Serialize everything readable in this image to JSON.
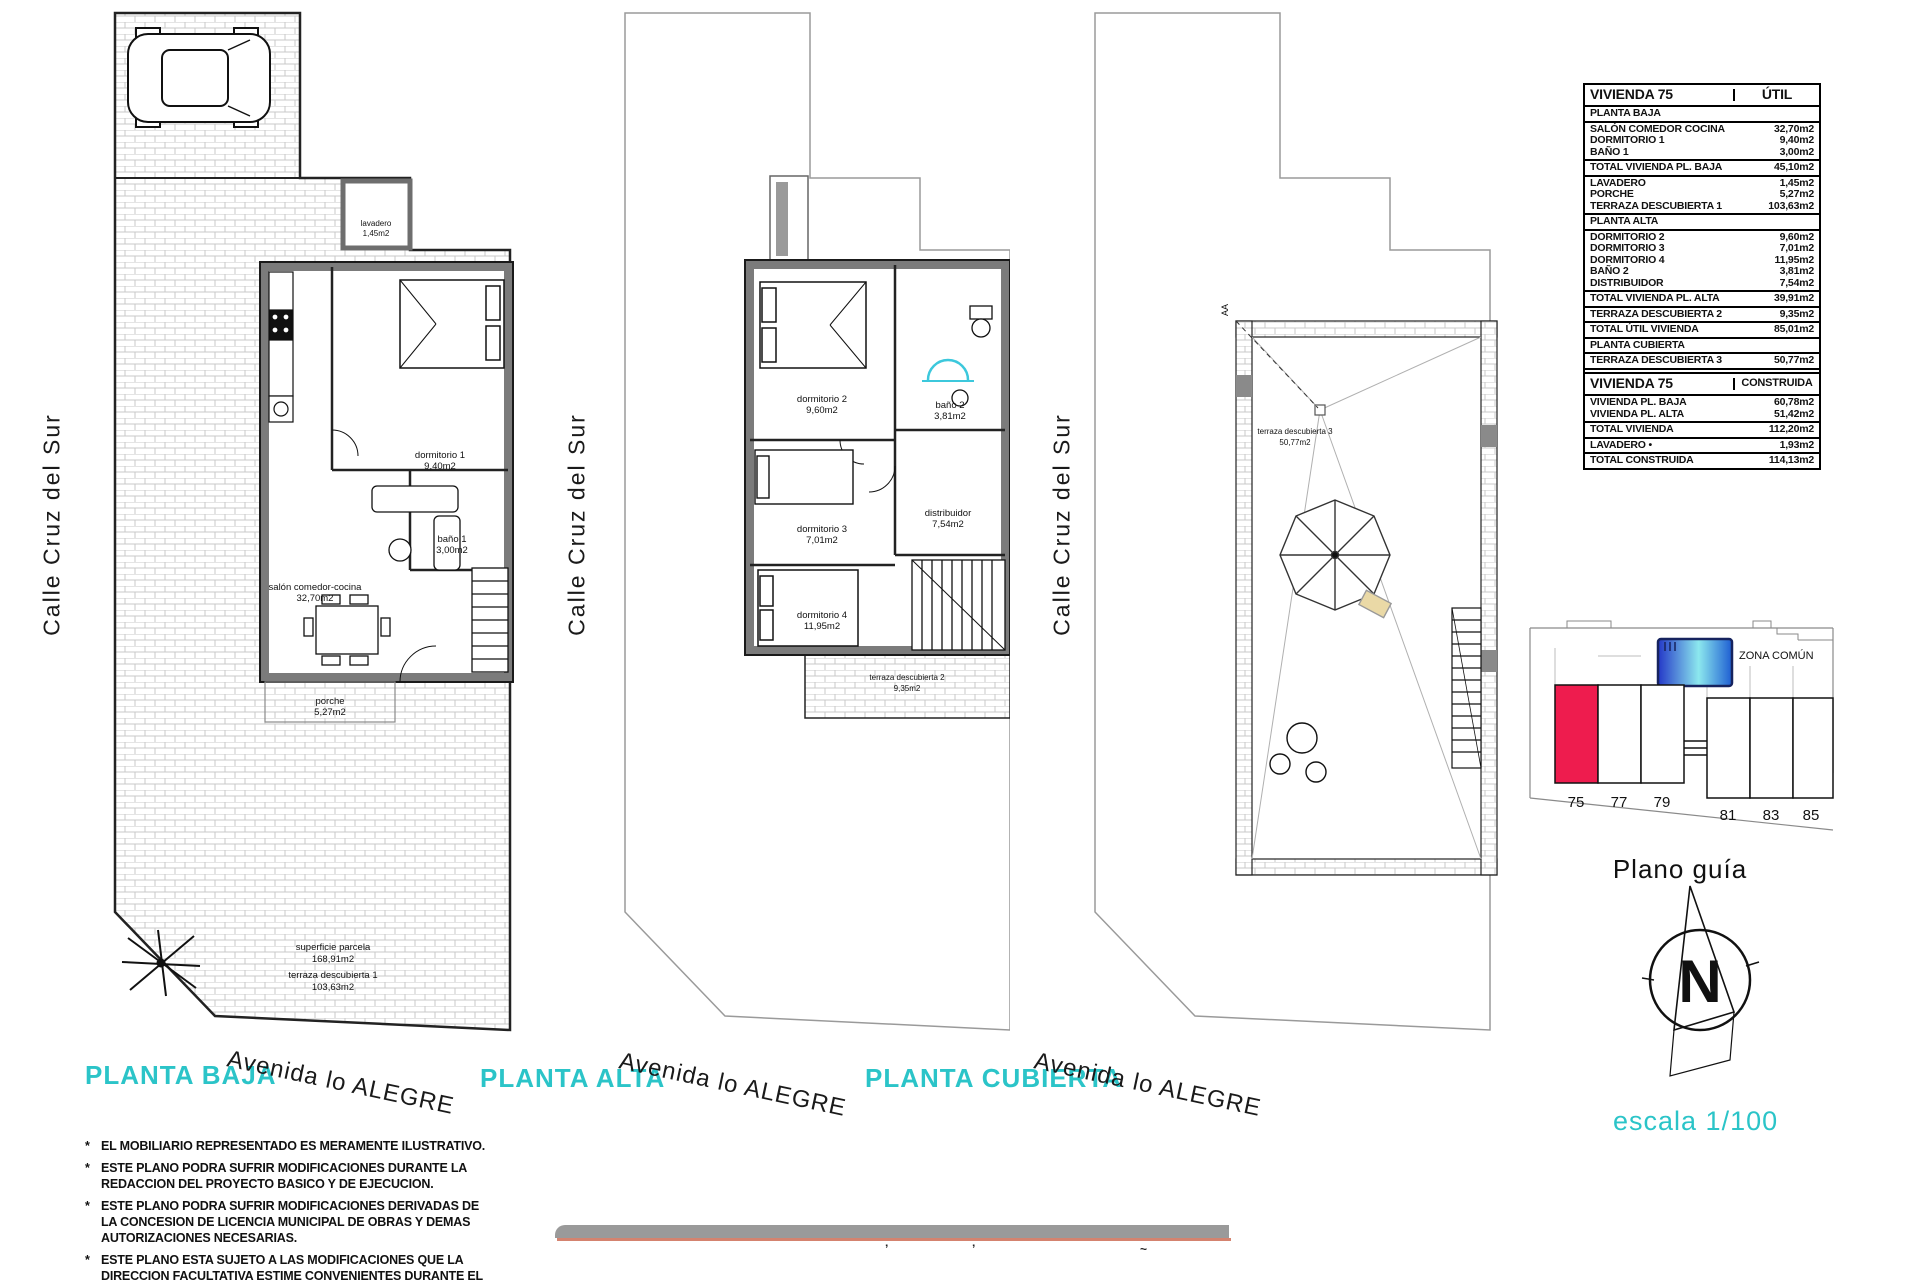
{
  "plans": [
    {
      "title": "PLANTA BAJA",
      "street": "Calle Cruz del Sur",
      "avenue": "Avenida lo ALEGRE",
      "rooms": [
        {
          "name": "lavadero",
          "area": "1,45m2"
        },
        {
          "name": "dormitorio 1",
          "area": "9,40m2"
        },
        {
          "name": "baño 1",
          "area": "3,00m2"
        },
        {
          "name": "salón comedor-cocina",
          "area": "32,70m2"
        },
        {
          "name": "porche",
          "area": "5,27m2"
        },
        {
          "name": "superficie parcela",
          "area": "168,91m2"
        },
        {
          "name": "terraza descubierta 1",
          "area": "103,63m2"
        }
      ]
    },
    {
      "title": "PLANTA ALTA",
      "street": "Calle Cruz del Sur",
      "avenue": "Avenida lo ALEGRE",
      "rooms": [
        {
          "name": "dormitorio 2",
          "area": "9,60m2"
        },
        {
          "name": "baño 2",
          "area": "3,81m2"
        },
        {
          "name": "distribuidor",
          "area": "7,54m2"
        },
        {
          "name": "dormitorio 3",
          "area": "7,01m2"
        },
        {
          "name": "dormitorio 4",
          "area": "11,95m2"
        },
        {
          "name": "terraza descubierta 2",
          "area": "9,35m2"
        }
      ]
    },
    {
      "title": "PLANTA CUBIERTA",
      "street": "Calle Cruz del Sur",
      "avenue": "Avenida lo ALEGRE",
      "section_marker": "AA",
      "rooms": [
        {
          "name": "terraza descubierta 3",
          "area": "50,77m2"
        }
      ]
    }
  ],
  "tables": {
    "util": {
      "title": "VIVIENDA 75",
      "col": "ÚTIL",
      "rows": [
        {
          "kind": "section",
          "label": "PLANTA BAJA",
          "value": ""
        },
        {
          "kind": "item",
          "label": "SALÓN COMEDOR COCINA",
          "value": "32,70m2"
        },
        {
          "kind": "item",
          "label": "DORMITORIO 1",
          "value": "9,40m2"
        },
        {
          "kind": "item",
          "label": "BAÑO 1",
          "value": "3,00m2"
        },
        {
          "kind": "total",
          "label": "TOTAL VIVIENDA PL. BAJA",
          "value": "45,10m2"
        },
        {
          "kind": "item",
          "label": "LAVADERO",
          "value": "1,45m2"
        },
        {
          "kind": "item",
          "label": "PORCHE",
          "value": "5,27m2"
        },
        {
          "kind": "item",
          "label": "TERRAZA DESCUBIERTA 1",
          "value": "103,63m2"
        },
        {
          "kind": "section",
          "label": "PLANTA ALTA",
          "value": ""
        },
        {
          "kind": "item",
          "label": "DORMITORIO 2",
          "value": "9,60m2"
        },
        {
          "kind": "item",
          "label": "DORMITORIO 3",
          "value": "7,01m2"
        },
        {
          "kind": "item",
          "label": "DORMITORIO 4",
          "value": "11,95m2"
        },
        {
          "kind": "item",
          "label": "BAÑO 2",
          "value": "3,81m2"
        },
        {
          "kind": "item",
          "label": "DISTRIBUIDOR",
          "value": "7,54m2"
        },
        {
          "kind": "total",
          "label": "TOTAL VIVIENDA PL. ALTA",
          "value": "39,91m2"
        },
        {
          "kind": "total",
          "label": "TERRAZA DESCUBIERTA 2",
          "value": "9,35m2"
        },
        {
          "kind": "total",
          "label": "TOTAL ÚTIL VIVIENDA",
          "value": "85,01m2"
        },
        {
          "kind": "section",
          "label": "PLANTA CUBIERTA",
          "value": ""
        },
        {
          "kind": "total",
          "label": "TERRAZA DESCUBIERTA 3",
          "value": "50,77m2"
        },
        {
          "kind": "total",
          "label": "PARCELA",
          "value": "168,91m2"
        }
      ]
    },
    "construida": {
      "title": "VIVIENDA 75",
      "col": "CONSTRUIDA",
      "rows": [
        {
          "kind": "item",
          "label": "VIVIENDA PL. BAJA",
          "value": "60,78m2"
        },
        {
          "kind": "item",
          "label": "VIVIENDA PL. ALTA",
          "value": "51,42m2"
        },
        {
          "kind": "total",
          "label": "TOTAL VIVIENDA",
          "value": "112,20m2"
        },
        {
          "kind": "total",
          "label": "LAVADERO •",
          "value": "1,93m2"
        },
        {
          "kind": "total",
          "label": "TOTAL CONSTRUIDA",
          "value": "114,13m2"
        }
      ]
    }
  },
  "plano_guia": {
    "title": "Plano guía",
    "zona_comun": "ZONA COMÚN",
    "units": [
      "75",
      "77",
      "79",
      "81",
      "83",
      "85"
    ],
    "highlighted_unit": "75",
    "highlight_color": "#ee1c4e"
  },
  "compass": {
    "north": "N"
  },
  "scale_label": "escala 1/100",
  "note_bullet": "*",
  "notes": [
    "EL MOBILIARIO REPRESENTADO ES MERAMENTE ILUSTRATIVO.",
    "ESTE PLANO PODRA SUFRIR MODIFICACIONES DURANTE LA REDACCION DEL PROYECTO BASICO Y DE EJECUCION.",
    "ESTE PLANO PODRA SUFRIR MODIFICACIONES DERIVADAS DE LA CONCESION DE LICENCIA MUNICIPAL DE OBRAS Y DEMAS AUTORIZACIONES NECESARIAS.",
    "ESTE PLANO ESTA SUJETO A LAS MODIFICACIONES QUE LA DIRECCION FACULTATIVA ESTIME CONVENIENTES DURANTE EL TRANSCURSO DE LA OBRA."
  ],
  "footer_marks": [
    "’",
    "’",
    "~"
  ],
  "colors": {
    "accent_cyan": "#2bc4c8",
    "unit_highlight_red": "#ee1c4e",
    "pool_dark_blue": "#2438c8",
    "pool_light_cyan": "#8ce8ee",
    "wall_gray": "#7b7b7b",
    "footer_salmon": "#d4836f"
  }
}
